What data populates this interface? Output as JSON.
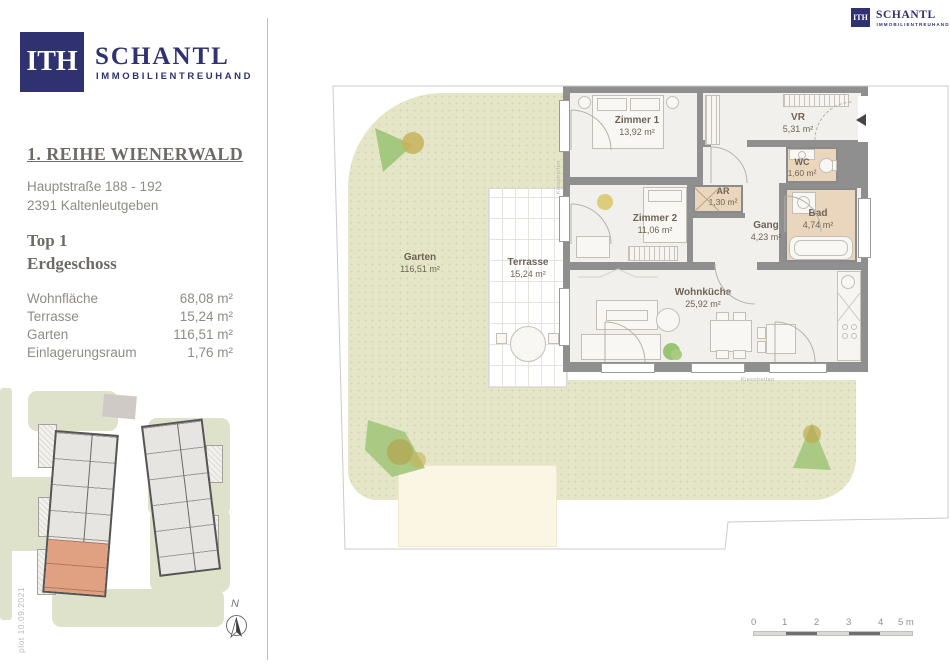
{
  "brand": {
    "monogram": "ITH",
    "name": "SCHANTL",
    "subtitle": "IMMOBILIENTREUHAND"
  },
  "project": {
    "title": "1. REIHE WIENERWALD",
    "address1": "Hauptstraße 188 - 192",
    "address2": "2391 Kaltenleutgeben",
    "unit": "Top 1",
    "floor": "Erdgeschoss"
  },
  "area_table": {
    "rows": [
      {
        "label": "Wohnfläche",
        "value": "68,08 m²"
      },
      {
        "label": "Terrasse",
        "value": "15,24 m²"
      },
      {
        "label": "Garten",
        "value": "116,51 m²"
      },
      {
        "label": "Einlagerungsraum",
        "value": "1,76 m²"
      }
    ]
  },
  "floorplan": {
    "rooms": [
      {
        "name": "Zimmer 1",
        "area": "13,92 m²"
      },
      {
        "name": "Zimmer 2",
        "area": "11,06 m²"
      },
      {
        "name": "VR",
        "area": "5,31 m²"
      },
      {
        "name": "WC",
        "area": "1,60 m²"
      },
      {
        "name": "AR",
        "area": "1,30 m²"
      },
      {
        "name": "Gang",
        "area": "4,23 m²"
      },
      {
        "name": "Bad",
        "area": "4,74 m²"
      },
      {
        "name": "Wohnküche",
        "area": "25,92 m²"
      }
    ],
    "outdoor": [
      {
        "name": "Garten",
        "area": "116,51 m²"
      },
      {
        "name": "Terrasse",
        "area": "15,24 m²"
      }
    ],
    "annotation_gravel": "Kiesstreifen"
  },
  "scale_bar": {
    "labels": [
      "0",
      "1",
      "2",
      "3",
      "4"
    ],
    "end_label": "5 m"
  },
  "compass": {
    "label": "N"
  },
  "stamp": "plot  10.09.2021",
  "colors": {
    "navy": "#2f3170",
    "highlight_salmon": "#e0a183",
    "garden_green": "#e4e6c7",
    "wet_room_beige": "#e9d6bd"
  }
}
